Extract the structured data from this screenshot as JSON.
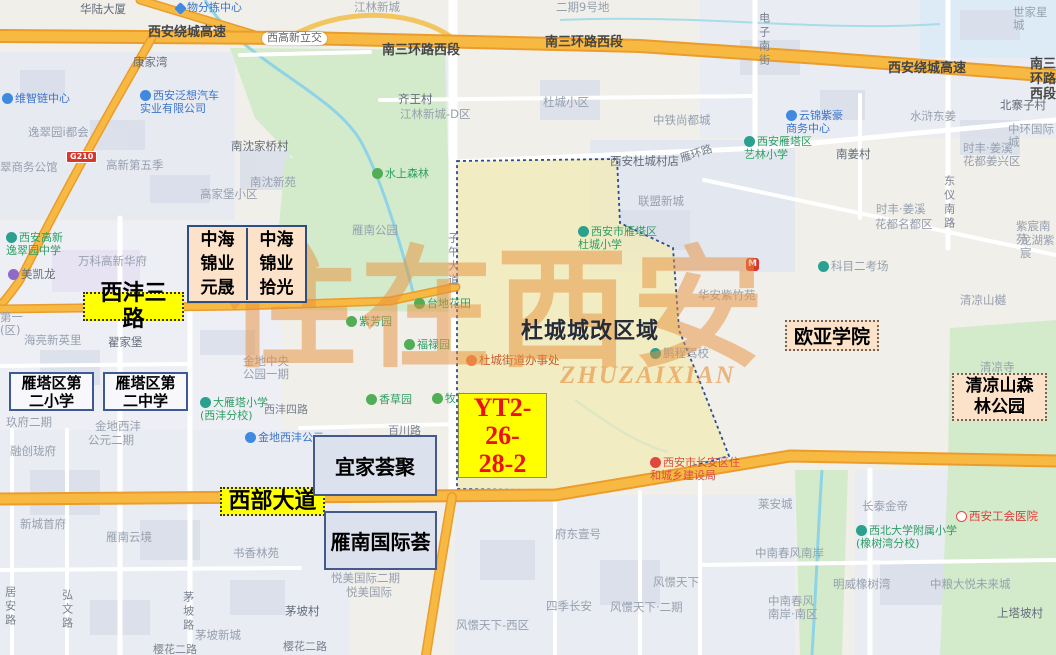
{
  "watermark": {
    "text": "住在西安",
    "subtext": "ZHUZAIXIAN"
  },
  "annotations": {
    "xifeng_road": "西沣三路",
    "west_avenue": "西部大道",
    "zhonghai_cells": [
      "中海\n锦业\n元晟",
      "中海\n锦业\n拾光"
    ],
    "school_primary": "雁塔区第\n二小学",
    "school_middle": "雁塔区第\n二中学",
    "ikea": "宜家荟聚",
    "yannan_intl": "雁南国际荟",
    "ouya_college": "欧亚学院",
    "qingliangshan_park": "清凉山森\n林公园",
    "plot_code": "YT2-\n26-\n28-2",
    "region_title": "杜城城改区域"
  },
  "map_labels": [
    {
      "t": "华陆大厦",
      "x": 80,
      "y": 3,
      "c": "v"
    },
    {
      "t": "物分拣中心",
      "x": 176,
      "y": 2,
      "c": "b",
      "i": "diamond"
    },
    {
      "t": "西安绕城高速",
      "x": 148,
      "y": 26,
      "c": "h"
    },
    {
      "t": "西高新立交",
      "x": 262,
      "y": 32,
      "c": "pill"
    },
    {
      "t": "南三环路西段",
      "x": 382,
      "y": 44,
      "c": "h"
    },
    {
      "t": "南三环路西段",
      "x": 545,
      "y": 36,
      "c": "h"
    },
    {
      "t": "西安绕城高速",
      "x": 888,
      "y": 62,
      "c": "h"
    },
    {
      "t": "南三环路西段",
      "x": 1030,
      "y": 58,
      "c": "h"
    },
    {
      "t": "康家湾",
      "x": 133,
      "y": 56,
      "c": "v"
    },
    {
      "t": "西安泛想汽车\n实业有限公司",
      "x": 140,
      "y": 90,
      "c": "b",
      "i": "dot-blue"
    },
    {
      "t": "维智链中心",
      "x": 2,
      "y": 93,
      "c": "b",
      "i": "dot-blue"
    },
    {
      "t": "逸翠园i都会",
      "x": 28,
      "y": 126,
      "c": "a"
    },
    {
      "t": "翠商务公馆",
      "x": 0,
      "y": 161,
      "c": "a"
    },
    {
      "t": "高新第五季",
      "x": 106,
      "y": 159,
      "c": "a"
    },
    {
      "t": "南沈家桥村",
      "x": 231,
      "y": 140,
      "c": "v"
    },
    {
      "t": "南沈新苑",
      "x": 250,
      "y": 176,
      "c": "a"
    },
    {
      "t": "高家堡小区",
      "x": 200,
      "y": 188,
      "c": "a"
    },
    {
      "t": "齐王村",
      "x": 398,
      "y": 93,
      "c": "v"
    },
    {
      "t": "江林新城-D区",
      "x": 400,
      "y": 108,
      "c": "a"
    },
    {
      "t": "江林新城",
      "x": 354,
      "y": 1,
      "c": "a"
    },
    {
      "t": "二期9号地",
      "x": 556,
      "y": 1,
      "c": "a"
    },
    {
      "t": "杜城小区",
      "x": 543,
      "y": 96,
      "c": "a"
    },
    {
      "t": "中铁尚都城",
      "x": 653,
      "y": 114,
      "c": "a"
    },
    {
      "t": "西安杜城村店",
      "x": 610,
      "y": 155,
      "c": "v"
    },
    {
      "t": "雁环路",
      "x": 680,
      "y": 148,
      "c": "r",
      "r": -18
    },
    {
      "t": "联盟新城",
      "x": 638,
      "y": 195,
      "c": "a"
    },
    {
      "t": "水上森林",
      "x": 372,
      "y": 168,
      "c": "g",
      "i": "dot-green"
    },
    {
      "t": "电子南街",
      "x": 757,
      "y": 12,
      "c": "r",
      "v": 1
    },
    {
      "t": "世家星城",
      "x": 1013,
      "y": 6,
      "c": "a"
    },
    {
      "t": "北寨子村",
      "x": 1000,
      "y": 99,
      "c": "v"
    },
    {
      "t": "中环国际城",
      "x": 1008,
      "y": 123,
      "c": "a"
    },
    {
      "t": "水浒东姜",
      "x": 910,
      "y": 110,
      "c": "a"
    },
    {
      "t": "云锦紫豪\n商务中心",
      "x": 786,
      "y": 110,
      "c": "b",
      "i": "dot-blue"
    },
    {
      "t": "西安雁塔区\n艺林小学",
      "x": 744,
      "y": 136,
      "c": "t",
      "i": "dot-teal"
    },
    {
      "t": "南姜村",
      "x": 836,
      "y": 148,
      "c": "v"
    },
    {
      "t": "时丰·姜溪\n花都姜兴区",
      "x": 963,
      "y": 142,
      "c": "a"
    },
    {
      "t": "东仪南路",
      "x": 942,
      "y": 175,
      "c": "r",
      "v": 1
    },
    {
      "t": "时丰·姜溪",
      "x": 876,
      "y": 203,
      "c": "a"
    },
    {
      "t": "西安高新\n逸翠园中学",
      "x": 6,
      "y": 232,
      "c": "t",
      "i": "dot-teal"
    },
    {
      "t": "万科高新华府",
      "x": 78,
      "y": 255,
      "c": "a"
    },
    {
      "t": "美凯龙",
      "x": 8,
      "y": 268,
      "c": "v",
      "i": "dot-purple"
    },
    {
      "t": "第一\n(区)",
      "x": 0,
      "y": 311,
      "c": "a"
    },
    {
      "t": "海亮新英里",
      "x": 24,
      "y": 334,
      "c": "a"
    },
    {
      "t": "翟家堡",
      "x": 108,
      "y": 336,
      "c": "v"
    },
    {
      "t": "雁南公园",
      "x": 352,
      "y": 224,
      "c": "a"
    },
    {
      "t": "子午大道",
      "x": 446,
      "y": 232,
      "c": "r",
      "v": 1
    },
    {
      "t": "台地花田",
      "x": 414,
      "y": 298,
      "c": "g",
      "i": "dot-green"
    },
    {
      "t": "紫芳园",
      "x": 346,
      "y": 316,
      "c": "g",
      "i": "dot-green"
    },
    {
      "t": "福禄园",
      "x": 404,
      "y": 339,
      "c": "g",
      "i": "dot-green"
    },
    {
      "t": "杜城街道办事处",
      "x": 466,
      "y": 354,
      "c": "org",
      "i": "pin-orange"
    },
    {
      "t": "西安市雁塔区\n杜城小学",
      "x": 578,
      "y": 226,
      "c": "t",
      "i": "dot-teal"
    },
    {
      "t": "华安紫竹苑",
      "x": 698,
      "y": 289,
      "c": "a"
    },
    {
      "t": "鹏程驾校",
      "x": 650,
      "y": 347,
      "c": "a",
      "i": "dot-teal"
    },
    {
      "t": "科目二考场",
      "x": 818,
      "y": 260,
      "c": "a",
      "i": "dot-teal"
    },
    {
      "t": "花都名都区",
      "x": 875,
      "y": 218,
      "c": "a"
    },
    {
      "t": "紫宸南苑",
      "x": 1016,
      "y": 220,
      "c": "a"
    },
    {
      "t": "龙湖紫宸",
      "x": 1020,
      "y": 234,
      "c": "a"
    },
    {
      "t": "M",
      "x": 746,
      "y": 258,
      "c": "m"
    },
    {
      "t": "清凉山樾",
      "x": 960,
      "y": 294,
      "c": "a"
    },
    {
      "t": "清凉寺",
      "x": 980,
      "y": 361,
      "c": "a"
    },
    {
      "t": "金地中央\n公园一期",
      "x": 243,
      "y": 355,
      "c": "a"
    },
    {
      "t": "大雁塔小学\n(西沣分校)",
      "x": 200,
      "y": 397,
      "c": "t",
      "i": "dot-teal"
    },
    {
      "t": "西沣四路",
      "x": 264,
      "y": 404,
      "c": "r"
    },
    {
      "t": "金地西沣",
      "x": 95,
      "y": 420,
      "c": "a"
    },
    {
      "t": "玖府二期",
      "x": 6,
      "y": 416,
      "c": "a"
    },
    {
      "t": "香草园",
      "x": 366,
      "y": 394,
      "c": "g",
      "i": "dot-green"
    },
    {
      "t": "牧草园",
      "x": 432,
      "y": 393,
      "c": "g",
      "i": "dot-green"
    },
    {
      "t": "百川路",
      "x": 388,
      "y": 425,
      "c": "r"
    },
    {
      "t": "悦美国际二期",
      "x": 331,
      "y": 572,
      "c": "a"
    },
    {
      "t": "悦美国际",
      "x": 346,
      "y": 586,
      "c": "a"
    },
    {
      "t": "融创珑府",
      "x": 10,
      "y": 445,
      "c": "a"
    },
    {
      "t": "公元二期",
      "x": 88,
      "y": 434,
      "c": "a"
    },
    {
      "t": "金地西沣公元",
      "x": 245,
      "y": 432,
      "c": "b",
      "i": "dot-blue"
    },
    {
      "t": "新城首府",
      "x": 20,
      "y": 518,
      "c": "a"
    },
    {
      "t": "雁南云境",
      "x": 106,
      "y": 531,
      "c": "a"
    },
    {
      "t": "书香林苑",
      "x": 233,
      "y": 547,
      "c": "a"
    },
    {
      "t": "居安路",
      "x": 3,
      "y": 586,
      "c": "r",
      "v": 1
    },
    {
      "t": "弘文路",
      "x": 60,
      "y": 589,
      "c": "r",
      "v": 1
    },
    {
      "t": "茅坡路",
      "x": 181,
      "y": 591,
      "c": "r",
      "v": 1
    },
    {
      "t": "茅坡村",
      "x": 285,
      "y": 605,
      "c": "v"
    },
    {
      "t": "茅坡新城",
      "x": 195,
      "y": 629,
      "c": "a"
    },
    {
      "t": "樱花二路",
      "x": 153,
      "y": 644,
      "c": "r"
    },
    {
      "t": "樱花二路",
      "x": 283,
      "y": 641,
      "c": "r"
    },
    {
      "t": "府东壹号",
      "x": 555,
      "y": 528,
      "c": "a"
    },
    {
      "t": "风憬天下",
      "x": 653,
      "y": 576,
      "c": "a"
    },
    {
      "t": "四季长安",
      "x": 546,
      "y": 600,
      "c": "a"
    },
    {
      "t": "风憬天下·二期",
      "x": 610,
      "y": 601,
      "c": "a"
    },
    {
      "t": "风憬天下-西区",
      "x": 456,
      "y": 619,
      "c": "a"
    },
    {
      "t": "西安市长安区住\n和城乡建设局",
      "x": 650,
      "y": 457,
      "c": "redpoi",
      "i": "pin-red"
    },
    {
      "t": "莱安城",
      "x": 758,
      "y": 498,
      "c": "a"
    },
    {
      "t": "长泰金帝",
      "x": 862,
      "y": 500,
      "c": "a"
    },
    {
      "t": "西安工会医院",
      "x": 956,
      "y": 510,
      "c": "red",
      "i": "cross-red"
    },
    {
      "t": "西北大学附属小学\n(橡树湾分校)",
      "x": 856,
      "y": 525,
      "c": "t",
      "i": "dot-teal"
    },
    {
      "t": "中南春风南岸",
      "x": 755,
      "y": 547,
      "c": "a"
    },
    {
      "t": "明威橡树湾",
      "x": 833,
      "y": 578,
      "c": "a"
    },
    {
      "t": "中南春风\n南岸·南区",
      "x": 768,
      "y": 595,
      "c": "a"
    },
    {
      "t": "中粮大悦未来城",
      "x": 930,
      "y": 578,
      "c": "a"
    },
    {
      "t": "上塔坡村",
      "x": 997,
      "y": 607,
      "c": "v"
    },
    {
      "t": "G210",
      "x": 66,
      "y": 151,
      "c": "shield"
    }
  ]
}
